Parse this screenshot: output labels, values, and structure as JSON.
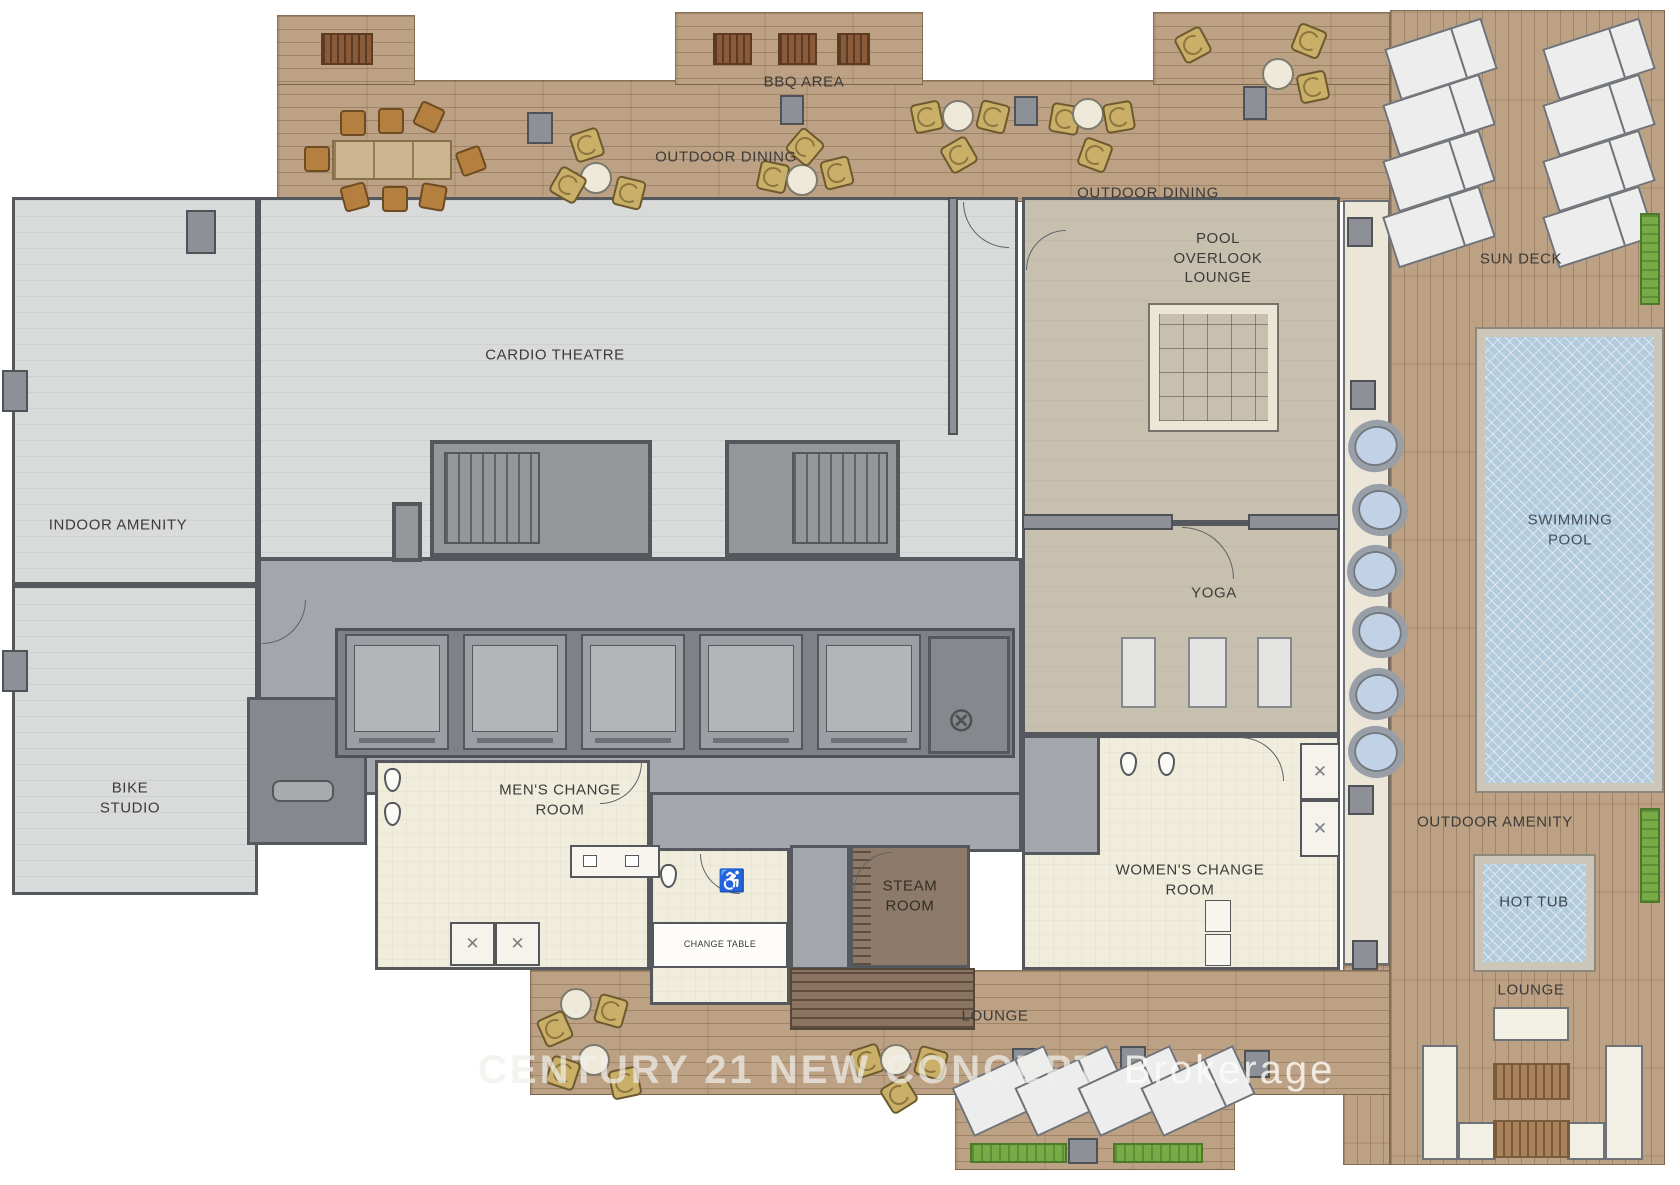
{
  "title": "Amenity Level Floor Plan",
  "watermark": {
    "brand": "CENTURY 21 NEW CONCEPT",
    "suffix": "Brokerage"
  },
  "labels": {
    "bbq_area": "BBQ AREA",
    "outdoor_dining_west": "OUTDOOR DINING",
    "outdoor_dining_east": "OUTDOOR DINING",
    "pool_overlook_lounge": "POOL\nOVERLOOK\nLOUNGE",
    "sun_deck": "SUN DECK",
    "cardio_theatre": "CARDIO THEATRE",
    "indoor_amenity": "INDOOR AMENITY",
    "swimming_pool": "SWIMMING POOL",
    "yoga": "YOGA",
    "bike_studio": "BIKE\nSTUDIO",
    "mens_change_room": "MEN'S CHANGE\nROOM",
    "steam_room": "STEAM\nROOM",
    "womens_change_room": "WOMEN'S CHANGE\nROOM",
    "change_table": "CHANGE TABLE",
    "outdoor_amenity": "OUTDOOR AMENITY",
    "hot_tub": "HOT TUB",
    "lounge_bottom": "LOUNGE",
    "lounge_right": "LOUNGE"
  },
  "glyphs": {
    "shower_x": "✕",
    "utility_chute": "⊗",
    "wheelchair": "♿"
  },
  "colors": {
    "deck_wood": "#bda184",
    "floor_light_gray": "#d9dada",
    "floor_taupe": "#c7c0ae",
    "floor_cream": "#f1eddd",
    "corridor_gray": "#a3a6aa",
    "wall_dark": "#55585c",
    "pool_water": "#b3ccdd",
    "steam_brown": "#8d7a68",
    "planter_green": "#76ab46",
    "chair_tan": "#c9af67",
    "table_wood": "#b5803f"
  }
}
